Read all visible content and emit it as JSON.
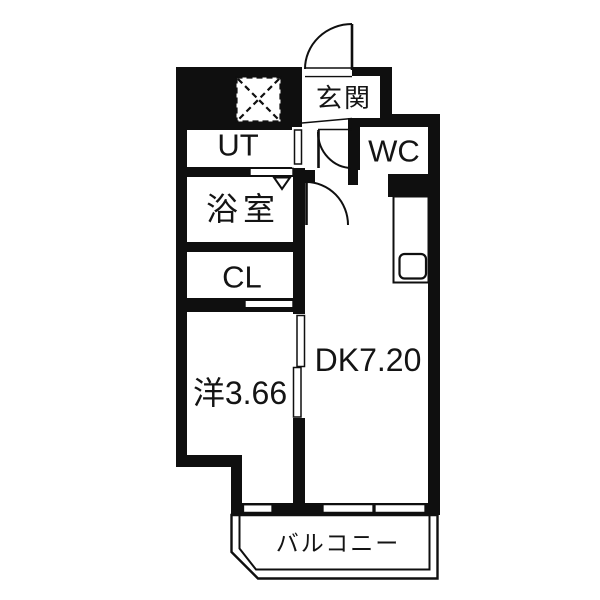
{
  "floorplan": {
    "type": "apartment-floor-plan",
    "colors": {
      "wall": "#0f0f0f",
      "background": "#ffffff",
      "text": "#141414"
    },
    "rooms": [
      {
        "id": "genkan",
        "label": "玄関",
        "kind": "entrance-hall"
      },
      {
        "id": "wc",
        "label": "WC",
        "kind": "toilet"
      },
      {
        "id": "ut",
        "label": "UT",
        "kind": "utility"
      },
      {
        "id": "bath",
        "label": "浴室",
        "kind": "bathroom"
      },
      {
        "id": "cl",
        "label": "CL",
        "kind": "closet"
      },
      {
        "id": "western",
        "label": "洋3.66",
        "kind": "western-room",
        "size_jo": "3.66"
      },
      {
        "id": "dk",
        "label": "DK7.20",
        "kind": "dining-kitchen",
        "size_jo": "7.20"
      },
      {
        "id": "balcony",
        "label": "バルコニー",
        "kind": "balcony"
      }
    ],
    "fixtures": [
      {
        "id": "washer-space",
        "symbol": "dashed-square-x"
      },
      {
        "id": "kitchen-sink",
        "symbol": "rounded-square-counter"
      },
      {
        "id": "entrance-door",
        "symbol": "quarter-arc-door"
      },
      {
        "id": "hall-door",
        "symbol": "quarter-arc-door"
      },
      {
        "id": "dk-door",
        "symbol": "quarter-arc-door"
      },
      {
        "id": "bath-door",
        "symbol": "triangle-marker"
      }
    ]
  }
}
